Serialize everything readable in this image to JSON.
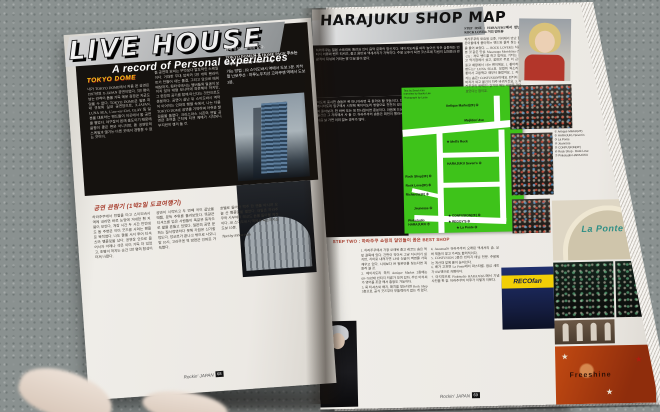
{
  "left_page": {
    "title": "LIVE HOUSE",
    "subtitle": "A record of Personal experiences",
    "tokyo_dome": {
      "heading": "TOKYO DOME",
      "col1": "내가 TOKYO DOME에서 처음 본 공연은 1997년의 X-JAPAN 공연이었다. 5만 명이 넘는 관객이 돔을 가득 메운 광경은 지금도 잊을 수 없다. TOKYO DOME은 일본 최대 규모의 실내 공연장으로, X-JAPAN, LUNA SEA, L'arc~en~Ciel, GLAY 등 일본을 대표하는 밴드들이 이곳에서 돔 공연을 열었다. 야구장이 본래 용도이기 때문에 음향이 좋은 편은 아니지만, 돔 공연만의 스케일과 열기는 다른 곳에서 경험할 수 없는 것이다.",
      "col2": "돔 공연의 묘미는 무엇보다 압도적인 스케일이다. 거대한 무대 장치와 5만 개의 펜라이트가 만들어 내는 물결, 그리고 앙코르 때의 떼창까지. 뒷좌석에서는 멤버들의 얼굴이 보이지 않아 대형 모니터에 의존해야 하지만, 그 현장의 공기를 함께 마신다는 것만으로도 충분하다. 공연이 끝난 뒤 스이도바시 역까지 이어지는 인파의 행렬 속에서, 나는 다음 TOKYO DOME 공연을 기약하며 아쉬운 발걸음을 돌렸다. 크리스마스 시즌의 연말 공연은 초여름 근처에 티켓 예매가 시작되니 부지런히 챙겨 둘 것.",
      "info_intro": "예매 정보는 아래와 같다.",
      "homepage_line": "TOKYO DOME의 홈 HOME PAGE 주소는",
      "homepage_url": "http://www.tokyo-dome.co.jp",
      "access": "가는 방법 : JR 스이도바시 역에서 도보 3분. 지하철 난보쿠선 · 마루노우치선 고라쿠엔 역에서 도보 3분."
    },
    "review": {
      "heading": "공연 관람기 (1박2일 도쿄여행기)",
      "col1": "하라주쿠에서 전철을 타고 스이도바시 역에 내리면 바로 눈앞에 거대한 흰 지붕이 보인다. 개장 시간 두 시간 전인데도 돔 주변은 이미 굿즈를 사려는 팬들로 북적였다. 나도 줄을 서서 투어 티셔츠와 팸플릿을 샀다. 공연장 안으로 들어서자 아레나 석은 이미 가득 차 있었고, 조명이 꺼지는 순간 5만 명의 함성이 터져 나왔다.",
      "col2": "공연이 시작되고 두 번째 곡이 끝났을 때쯤, 문득 주위를 둘러보았다. 똑같은 티셔츠를 입은 사람들이 똑같은 동작으로 팔을 흔들고 있었다. 일본의 공연 문화는 질서정연하다 못해 가끔은 신기할 정도다. 앙코르가 끝나고 밖으로 나오니 밤 10시. 고라쿠엔 역 방면은 인파로 가득했다.",
      "col3": "호텔로 돌아와 맥주 한 캔을 마시며 오늘 산 팸플릿을 펼쳤다. 내일은 하라주쿠와 시부야의 레코드 숍을 돌아볼 예정이다. JR 스이도바시 역에서 숙소까지는 도보 10분.",
      "credit": "Text by Inhee Kim"
    },
    "footer": {
      "magazine": "Rockin' JAPAN",
      "page": "68"
    }
  },
  "right_page": {
    "title": "HARAJUKU SHOP MAP",
    "intro1": "하라주쿠는 일본 스트리트 패션과 인디 음악 문화의 발신지다. 메이지도리를 따라 늘어선 작은 숍들에는 빈티지 의류와 밴드 티셔츠, 중고 음반과 액세서리가 가득하다. 주말 오후가 되면 코스프레 차림의 십대들과 관광객이 뒤섞여 거리는 발 디딜 틈이 없다.",
    "intro2": "지도에 표시한 숍들은 록 마니아라면 꼭 들러야 할 곳들이다. 다케시타도리 입구에서 시작해 메이지도리 방향으로 천천히 걸으며 돌아보자. 한 바퀴 도는 데 한나절이면 충분하다. 마음에 드는 물건은 그 자리에서 사 둘 것. 하라주쿠의 숍들은 회전이 빨라서 다음 날 가면 이미 없는 경우가 많다.",
    "map": {
      "credits": "Text by Serah Kim\nInterview by Naoko Lee\nPhotograph by Lucie",
      "labels": [
        "Antique Market(2F) ④",
        "Meijidori Ave",
        "★ Mell's Rock",
        "HARAJUKU Seven's ②",
        "Rock Shop(3F) ⑥",
        "Rock Love(3F) ⑥",
        "Richards(1F) ⑥",
        "Jeunesse ④",
        "Pinkstudio\nHARAJUKU ⑦",
        "★ CONFUSION(2F) ⑤",
        "★ REGGY'S ②",
        "★ La Ponte ③"
      ]
    },
    "step_one": {
      "heading": "STEP ONE : HARAJUKU에서 만난 ROCK LOVER 거리 인터뷰",
      "body": "하라주쿠의 토요일 오후, 거리에서 만난 젊은이들에게 좋아하는 밴드와 즐겨 찾는 숍을 물어 보았다. — ROCK LOVER는 처음 본 것 같은 인상. Masatsugu Morishima (남·21) : 저도 밴드를 하고 있어요. 기타는 중고 악기점에서 샀고, 음반은 주로 이 근처 중고 매장에서 사는 편이에요. 1. 좋아하는 밴드는? LUNA SEA요. 보컬의 목소리가 좋아서 고등학교 때부터 들었어요. 2. 자주 가는 숍은? CONFUSION이에요. 빈티지 청바지가 싸고 물건이 자주 바뀌거든요. 3. 하라주쿠의 매력은? 걷기만 해도 새로운 것이 보인다는 점이죠."
    },
    "captions": "① Antique Market(2F)\n② HARAJUKU Seven's\n③ La Ponte\n④ Jeunesse\n⑤ CONFUSION(2F)\n⑥ Rock Shop · Rock Love\n⑦ Pinkstudio HARAJUKU",
    "step_two": {
      "heading": "STEP TWO : 하라주쿠 쇼핑의 달인들이 꼽은 BEST SHOP",
      "col1": "1. 하라주쿠에서 가장 오래된 중고 레코드 숍은 역 앞 골목에 있다. 간판이 작아서 그냥 지나치기 쉽지만, 지하로 내려가면 LP와 싱글이 벽면을 가득 채우고 있다. 시세보다 싼 일본반을 찾는다면 꼭 들러 볼 것.\n2. 메이지도리 쪽의 Antique Market 2층에는 60~70년대 빈티지 의류가 모여 있다. 주인 아저씨가 영어를 조금 해서 흥정도 가능하다.\n3. 록 티셔츠와 배지, 패치를 찾는다면 Rock Shop 3층으로. 공식 굿즈부터 부틀렉까지 없는 게 없다.",
      "col2": "4. Jeunesse는 하라주쿠의 오래된 액세서리 숍. 실버 제품이 많고 가격도 합리적이다.\n5. CONFUSION 2층은 빈티지 데님 전문. 주말에는 계산대 앞에 줄이 늘어선다.\n6. 배가 고프면 La Ponte에서 파스타를. 점심 세트가 850엔으로 저렴하다.\n7. 마지막으로 Pinkstudio HARAJUKU에서 기념 사진을 한 장. 하라주쿠의 하루가 이렇게 저문다."
    },
    "signs": {
      "la_ponte": "La Ponte",
      "recofan": "RECOfan",
      "collage": "Freeshine"
    },
    "footer": {
      "magazine": "Rockin' JAPAN",
      "page": "69"
    }
  }
}
